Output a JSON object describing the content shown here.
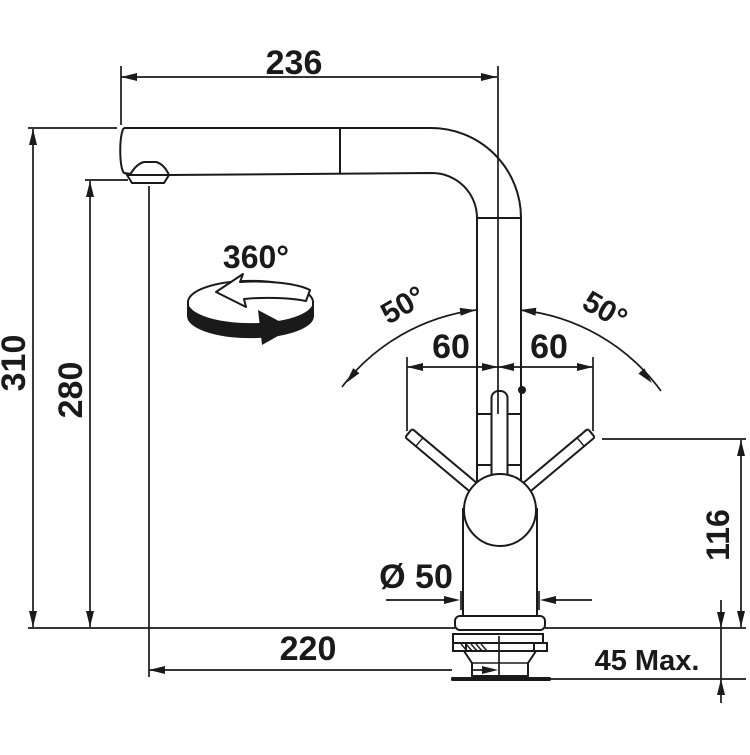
{
  "colors": {
    "line": "#1a1a1a",
    "background": "#ffffff"
  },
  "labels": {
    "spout_reach": "236",
    "overall_height": "310",
    "outlet_height": "280",
    "swivel": "360°",
    "tilt_left": "50°",
    "tilt_right": "50°",
    "clearance_left": "60",
    "clearance_right": "60",
    "handle_height": "116",
    "diameter": "Ø 50",
    "reach_to_axis": "220",
    "max_thickness": "45 Max."
  }
}
